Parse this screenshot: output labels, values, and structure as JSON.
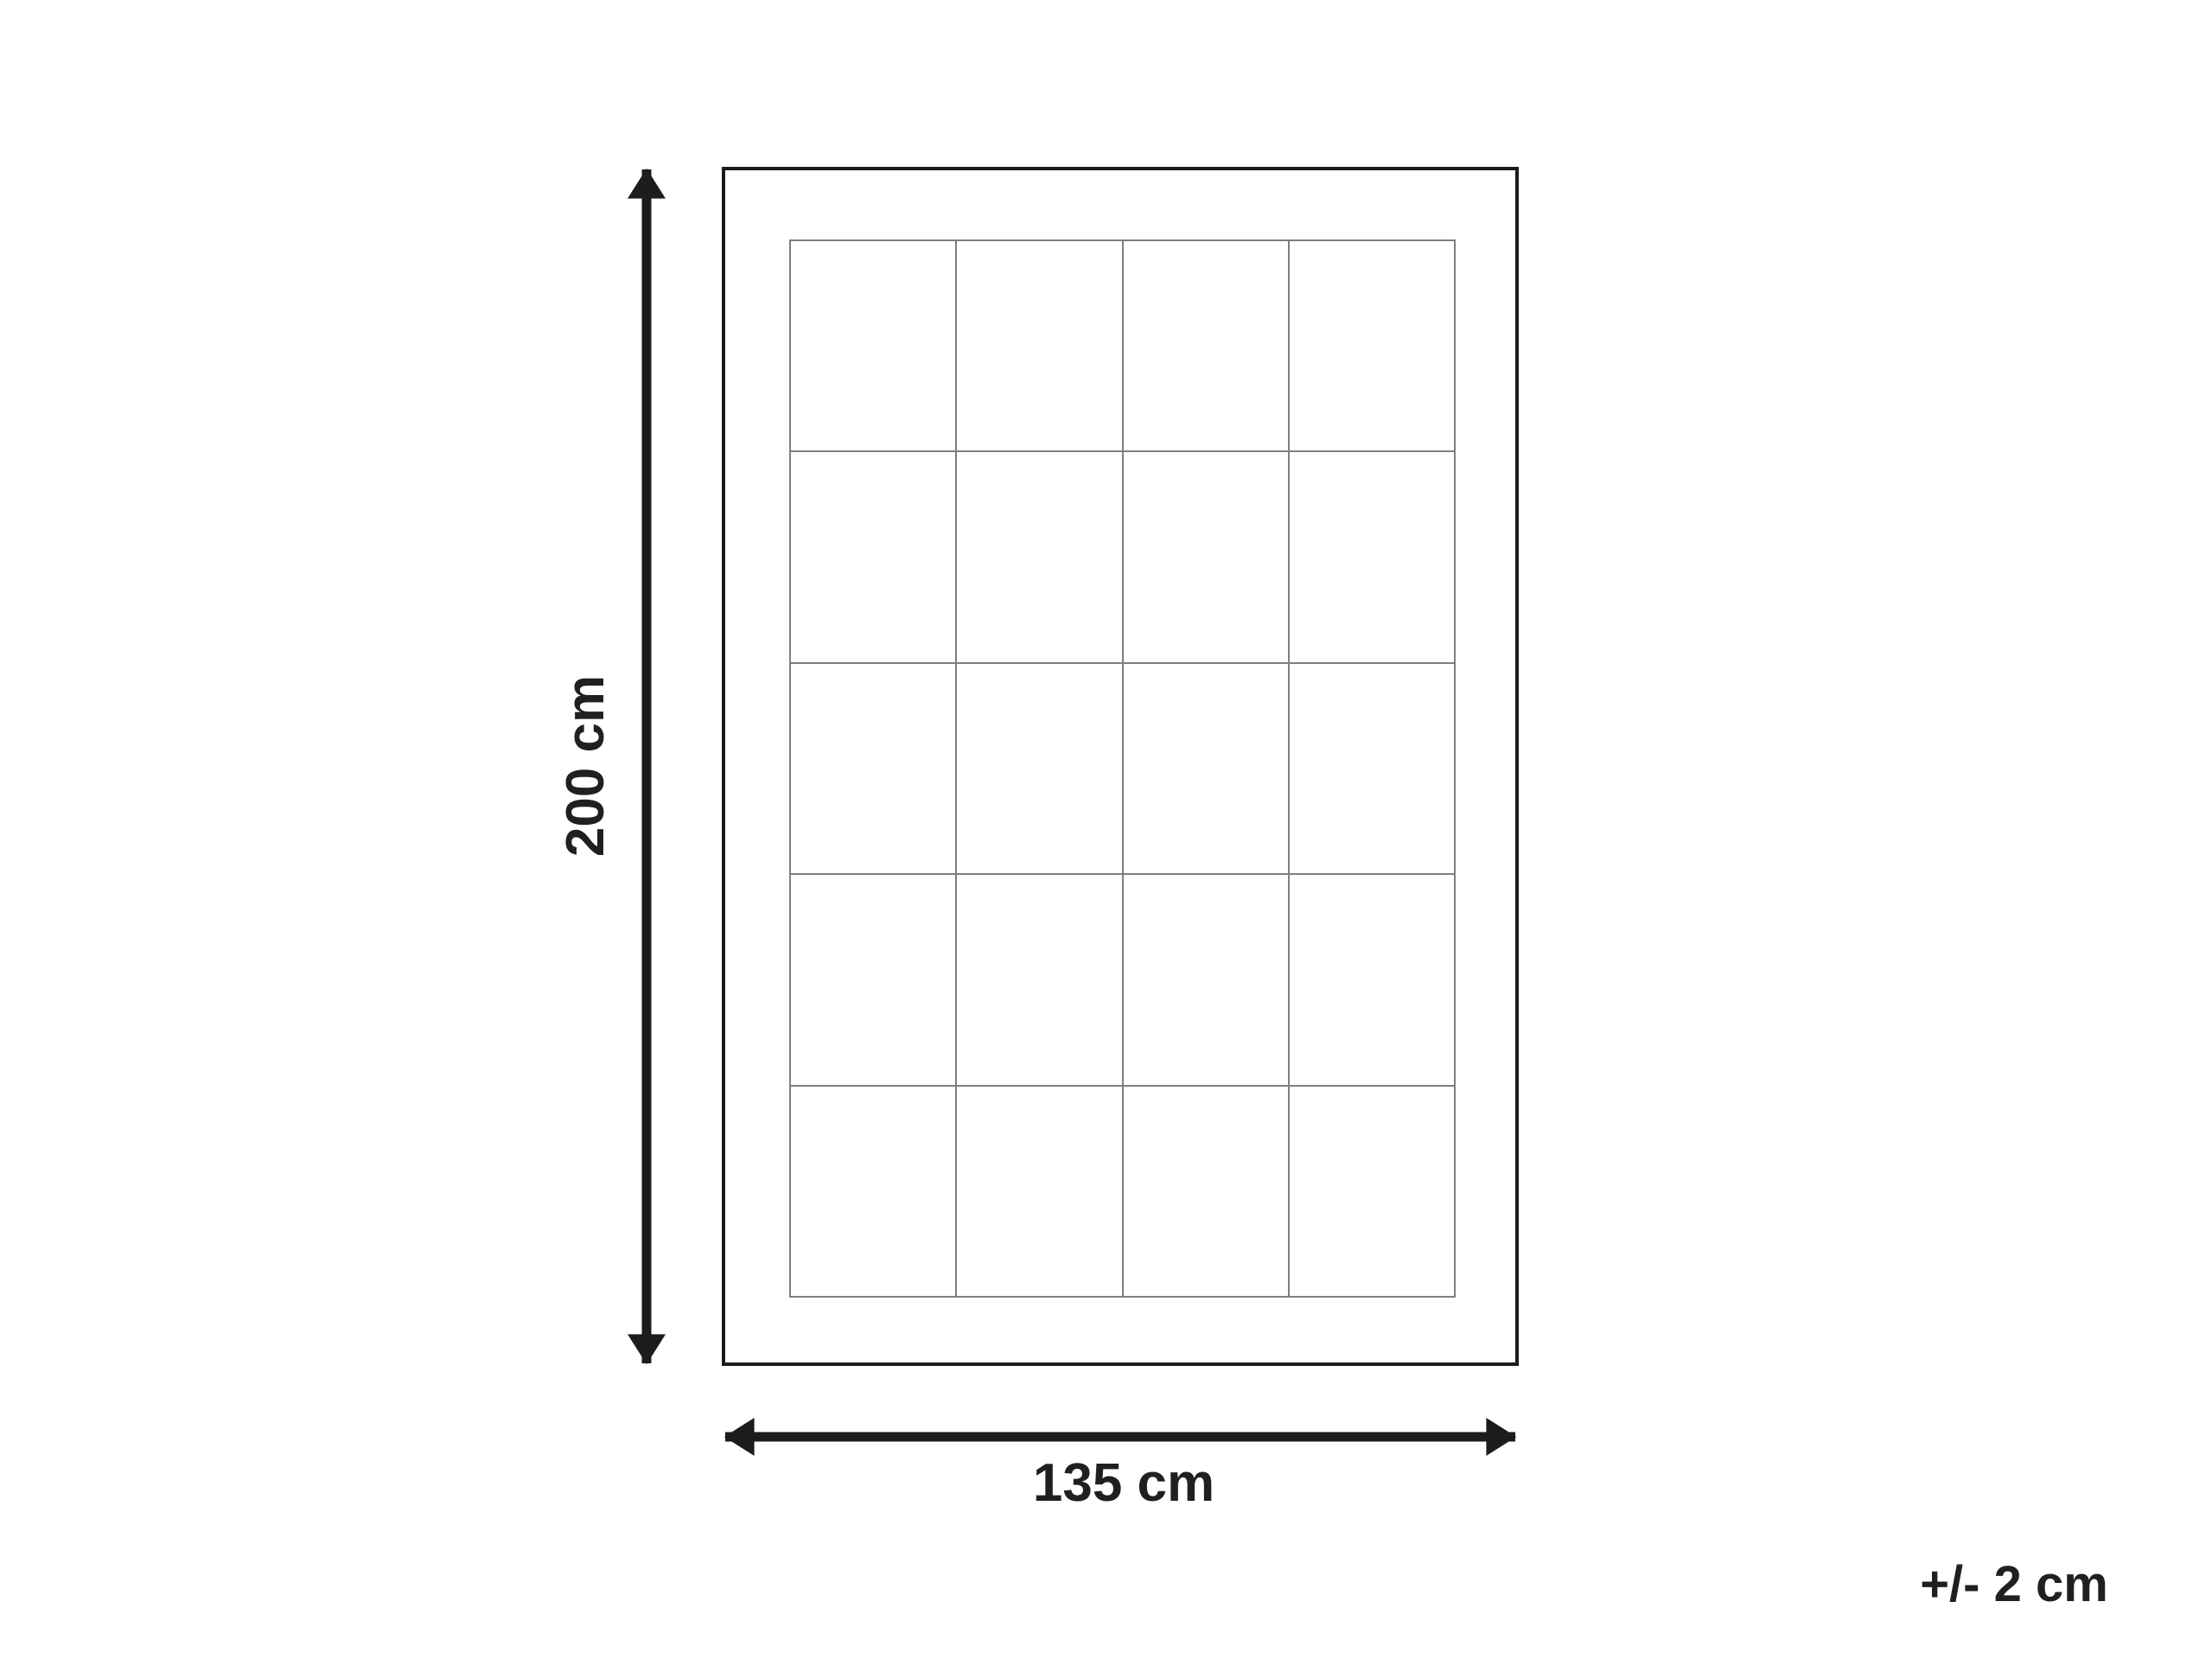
{
  "diagram": {
    "kind": "product-dimension-diagram",
    "height_dimension": {
      "label": "200 cm"
    },
    "width_dimension": {
      "label": "135 cm"
    },
    "tolerance": {
      "label": "+/- 2 cm"
    },
    "grid": {
      "columns": 4,
      "rows": 5
    },
    "colors": {
      "outline": "#1c1c1c",
      "arrow": "#1c1c1c",
      "grid_line": "#7f7f7f",
      "text": "#231f20",
      "background": "#ffffff"
    }
  }
}
